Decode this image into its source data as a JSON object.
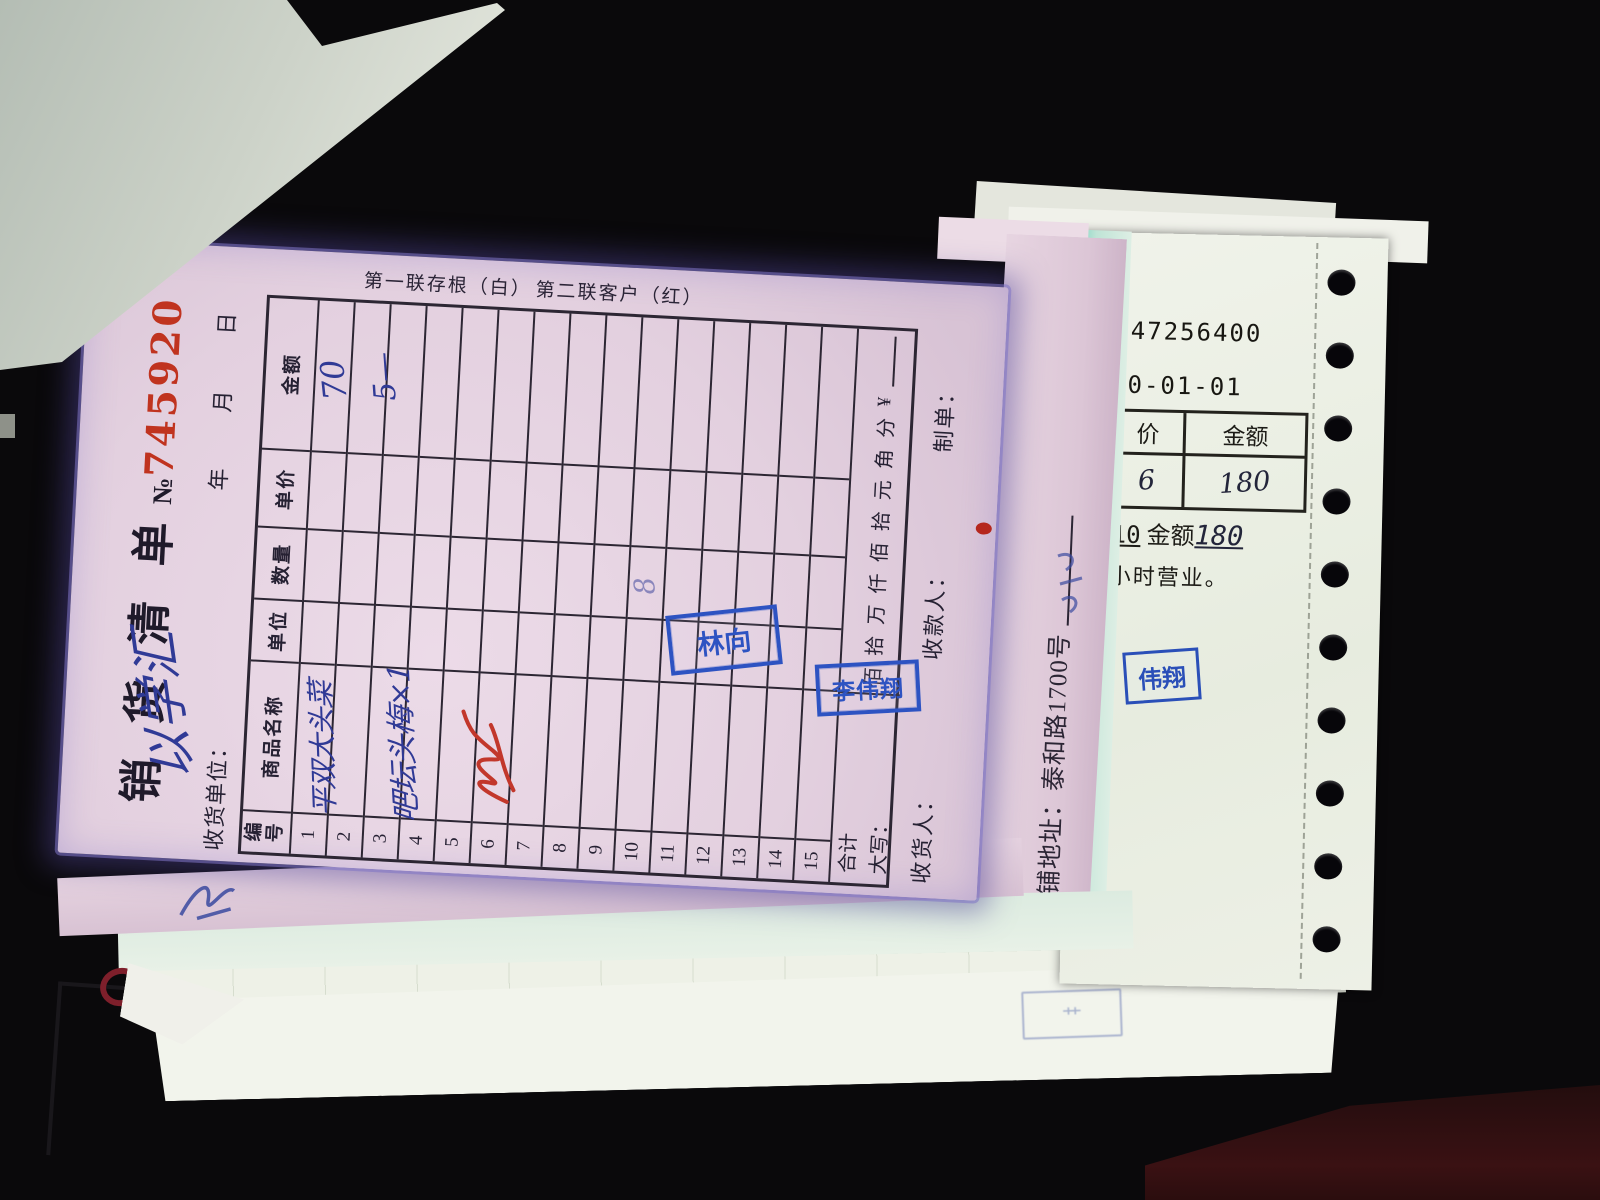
{
  "scene": {
    "description": "Photo of a stack of Chinese sales receipts on a black table; a pink sales-list form lies rotated sideways on top of a dot-matrix store receipt and other sheets."
  },
  "form": {
    "title": "销 货 清 单",
    "no_label": "№",
    "no_value": "745920",
    "date_line": "年　　月　　日",
    "customer_label": "收货单位：",
    "customer_handwritten": "以学汇",
    "copy1_note": "第一联存根（白）",
    "copy2_note": "第二联客户（红）",
    "col_headers": [
      "编号",
      "商品名称",
      "单位",
      "数量",
      "单价",
      "金额"
    ],
    "row_numbers": [
      "1",
      "2",
      "3",
      "4",
      "5",
      "6",
      "7",
      "8",
      "9",
      "10",
      "11",
      "12",
      "13",
      "14",
      "15"
    ],
    "entries": {
      "row1_amount": "70",
      "row2_name": "平双大头菜",
      "row2_amount": "5—",
      "row3_name": "吧坛头梅×1",
      "row8_qty": "8"
    },
    "total_label": "合计",
    "words_label": "大写：",
    "amount_words": [
      "佰",
      "拾",
      "万",
      "仟",
      "佰",
      "拾",
      "元",
      "角",
      "分"
    ],
    "currency_symbol": "¥",
    "receiver_label": "收货人：",
    "cashier_label": "收款人：",
    "preparer_label": "制单："
  },
  "stamps": {
    "stamp1_name": "林向",
    "stamp2_name": "李伟翔",
    "fragment_name": "伟翔"
  },
  "address_sheet": {
    "address_label": "商铺地址：泰和路1700号"
  },
  "receipt": {
    "number_partial": "847256400",
    "date_partial": "20-01-01",
    "col_price_partial": "价",
    "col_amount": "金额",
    "price_value_partial": "6",
    "amount_value": "180",
    "qty_value": "10",
    "amount_label": "金额",
    "amount_value2": "180",
    "hours_note_partial": "小时营业。"
  }
}
